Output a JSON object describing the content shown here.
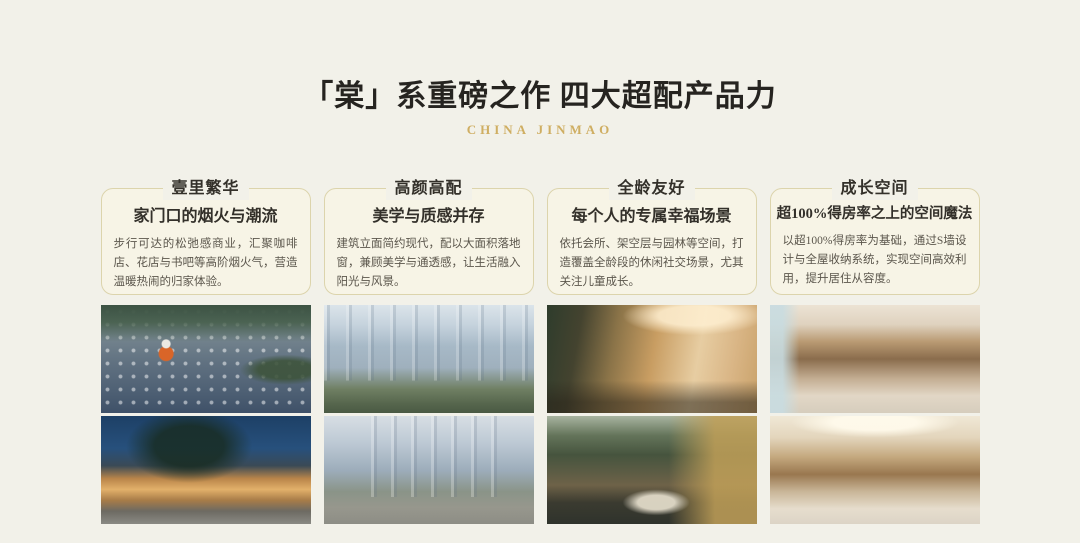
{
  "page": {
    "title": "「棠」系重磅之作  四大超配产品力",
    "brand": "CHINA JINMAO"
  },
  "colors": {
    "page_bg": "#f2f1e9",
    "card_bg": "#f7f4e6",
    "card_border": "#dcd4ac",
    "title_text": "#262420",
    "heading_text": "#33302a",
    "body_text": "#5b564c",
    "brand_gold": "#cfae62"
  },
  "columns": [
    {
      "heading": "壹里繁华",
      "subheading": "家门口的烟火与潮流",
      "body": "步行可达的松弛感商业，汇聚咖啡店、花店与书吧等高阶烟火气，营造温暖热闹的归家体验。",
      "photos": [
        "aerial-plaza-dusk-photo",
        "retail-street-night-photo"
      ]
    },
    {
      "heading": "高颜高配",
      "subheading": "美学与质感并存",
      "body": "建筑立面简约现代，配以大面积落地窗，兼顾美学与通透感，让生活融入阳光与风景。",
      "photos": [
        "residential-towers-day-photo",
        "tower-garden-path-photo"
      ]
    },
    {
      "heading": "全龄友好",
      "subheading": "每个人的专属幸福场景",
      "body": "依托会所、架空层与园林等空间，打造覆盖全龄段的休闲社交场景，尤其关注儿童成长。",
      "photos": [
        "clubhouse-lounge-photo",
        "courtyard-garden-dusk-photo"
      ]
    },
    {
      "heading": "成长空间",
      "subheading": "超100%得房率之上的空间魔法",
      "body": "以超100%得房率为基础，通过S墙设计与全屋收纳系统，实现空间高效利用，提升居住从容度。",
      "photos": [
        "bedroom-wardrobe-photo",
        "home-storage-bar-photo"
      ]
    }
  ]
}
